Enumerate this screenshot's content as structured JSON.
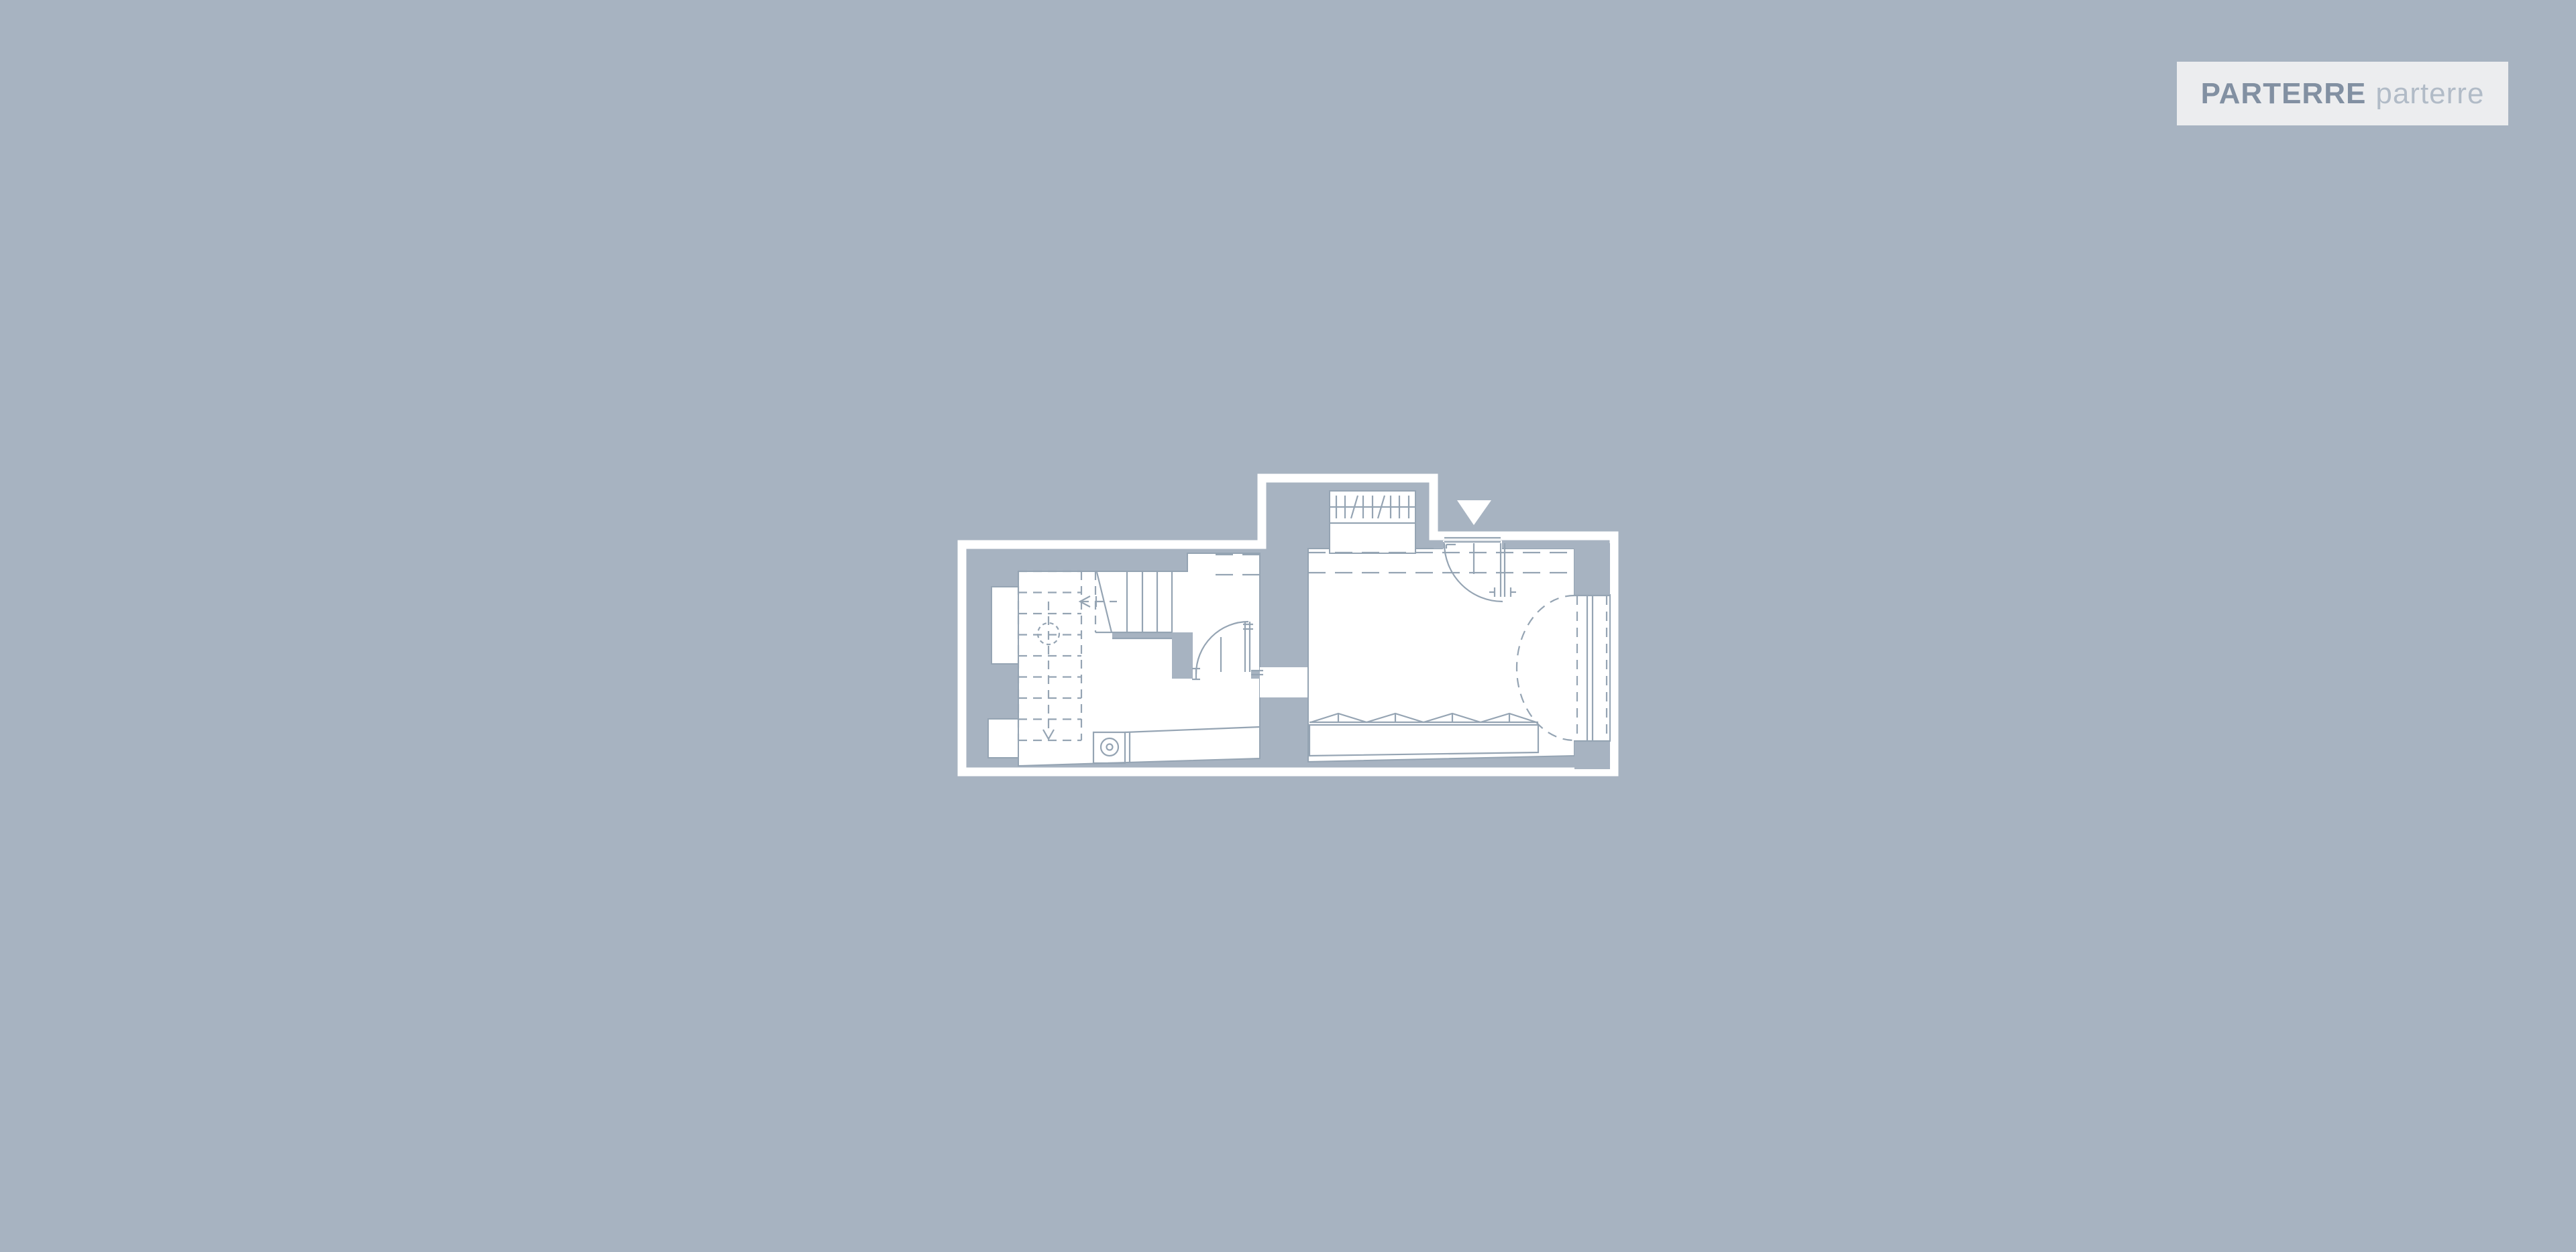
{
  "theme": {
    "background": "#a7b3c1",
    "wall": "#a7b3c1",
    "room": "#ffffff",
    "outline": "#ffffff",
    "line": "#95a4b3",
    "badge_background": "#ecedef",
    "badge_title_color": "#8290a2",
    "badge_subtitle_color": "#b1bbc7"
  },
  "floor_selector": {
    "title": "PARTERRE",
    "subtitle": "parterre"
  },
  "plan": {
    "floor_name": "PARTERRE",
    "symbols": [
      "building-outline",
      "staircase-dashed-flight",
      "staircase-solid-flight",
      "stair-walk-line",
      "interior-door-swing",
      "entrance-door-swing",
      "entrance-marker-triangle",
      "exterior-steps-hatch",
      "washing-machine",
      "radiator-bench",
      "bay-window-dashed-arc",
      "window-glazing-band",
      "corridor-overhang-dashed-lines",
      "window-niche-upper",
      "window-niche-lower"
    ]
  }
}
